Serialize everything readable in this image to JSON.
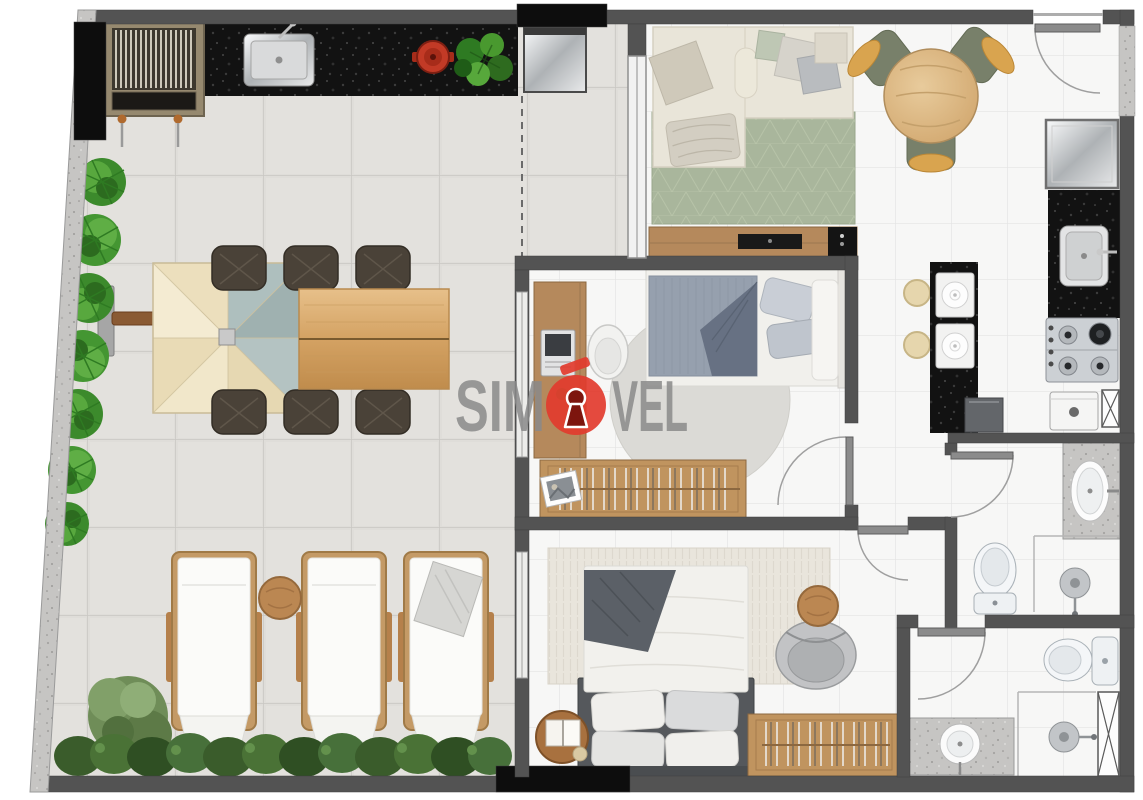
{
  "watermark": {
    "segment_before": "SIM",
    "segment_after": "VEL",
    "accent_letter": "Ó",
    "icon": "keyhole-icon",
    "brand_red": "#e23b2e",
    "text_gray": "#8a8a8a"
  },
  "floor_plan": {
    "type": "apartment-floor-plan-top-view",
    "rooms": [
      {
        "name": "terrace-gourmet",
        "furniture": [
          "barbecue-grill",
          "skewers",
          "granite-counter",
          "counter-sink",
          "red-pot",
          "potted-plant",
          "mini-fridge",
          "patio-umbrella",
          "umbrella-base",
          "plank-dining-table",
          "wicker-chair-x6",
          "sun-lounger-x3",
          "round-side-table",
          "towel",
          "palm-shrub-row",
          "hedge-row",
          "tree"
        ]
      },
      {
        "name": "living-room",
        "furniture": [
          "l-shaped-sofa",
          "throw-pillows",
          "blanket",
          "green-area-rug",
          "tv-console",
          "tv",
          "speaker-box",
          "round-dining-table",
          "dining-chair-x3"
        ]
      },
      {
        "name": "kitchen",
        "furniture": [
          "refrigerator",
          "granite-counter",
          "kitchen-sink",
          "cooktop-4-burners",
          "breakfast-island",
          "bar-stool-x2",
          "place-setting-x2",
          "under-counter-appliance",
          "washing-machine",
          "duct-shaft"
        ]
      },
      {
        "name": "bedroom-1",
        "furniture": [
          "single-bed",
          "desk",
          "laptop",
          "desk-chair",
          "round-rug",
          "open-wardrobe",
          "picture-frame"
        ]
      },
      {
        "name": "bedroom-2",
        "furniture": [
          "double-bed",
          "throw-blanket",
          "pillows",
          "fringed-rug",
          "armchair",
          "wood-side-table",
          "round-table-with-book",
          "open-wardrobe"
        ]
      },
      {
        "name": "bathroom-1",
        "furniture": [
          "granite-vanity",
          "oval-sink",
          "toilet",
          "shower-head"
        ]
      },
      {
        "name": "bathroom-2",
        "furniture": [
          "granite-vanity",
          "round-sink",
          "toilet",
          "shower-head",
          "duct-shaft"
        ]
      },
      {
        "name": "hallway",
        "furniture": []
      }
    ],
    "doors": [
      "entry-door",
      "bedroom-1-door",
      "bedroom-2-door",
      "bathroom-1-door",
      "bathroom-2-door"
    ],
    "windows": [
      "living-room-glass-wall",
      "bedroom-1-window",
      "bedroom-2-window"
    ],
    "palette": {
      "wall": "#535353",
      "structural_black": "#0d0d0d",
      "terrace_tile": "#dfddd9",
      "interior_tile": "#f7f7f6",
      "granite_dark": "#121212",
      "granite_light": "#c6c5c3",
      "wood": "#c0945f",
      "rug_green": "#a9b69c",
      "sofa_cream": "#e9e5d9",
      "plant_green": "#3c8a2c"
    }
  }
}
